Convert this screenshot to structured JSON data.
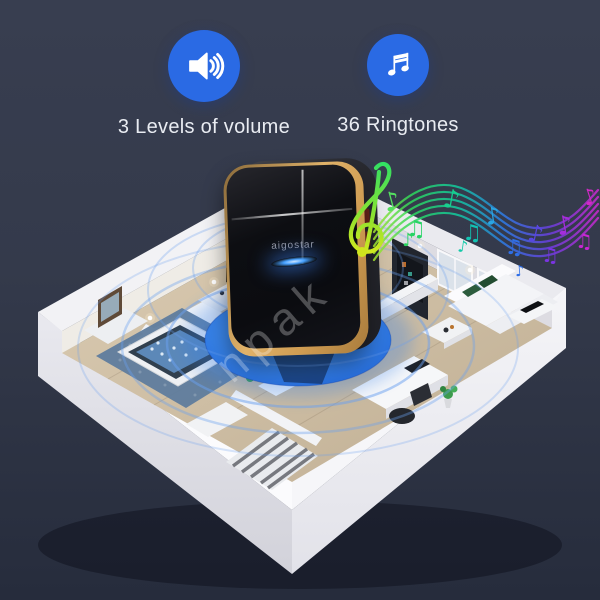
{
  "theme": {
    "bg-top": "#383e50",
    "bg-mid": "#343a4b",
    "bg-bottom": "#262c3c",
    "accent-blue": "#2a6ae4",
    "text-color": "#e9ecf2",
    "disc-blue": "#2e79e7",
    "ring-blue": "#6aa0ef",
    "gold": "#cf9c52",
    "led-blue": "#45a0ff",
    "device-black": "#0b0c10"
  },
  "features": [
    {
      "label": "3 Levels of volume",
      "icon": "speaker-volume-icon"
    },
    {
      "label": "36 Ringtones",
      "icon": "music-note-icon"
    }
  ],
  "device": {
    "brand": "aigostar"
  },
  "watermark": {
    "text": "npak"
  },
  "music_colors": [
    "#aee428",
    "#2ed95c",
    "#17cf8f",
    "#12c3b2",
    "#2f7ce8",
    "#5946e0",
    "#9333ea",
    "#c926d4"
  ]
}
